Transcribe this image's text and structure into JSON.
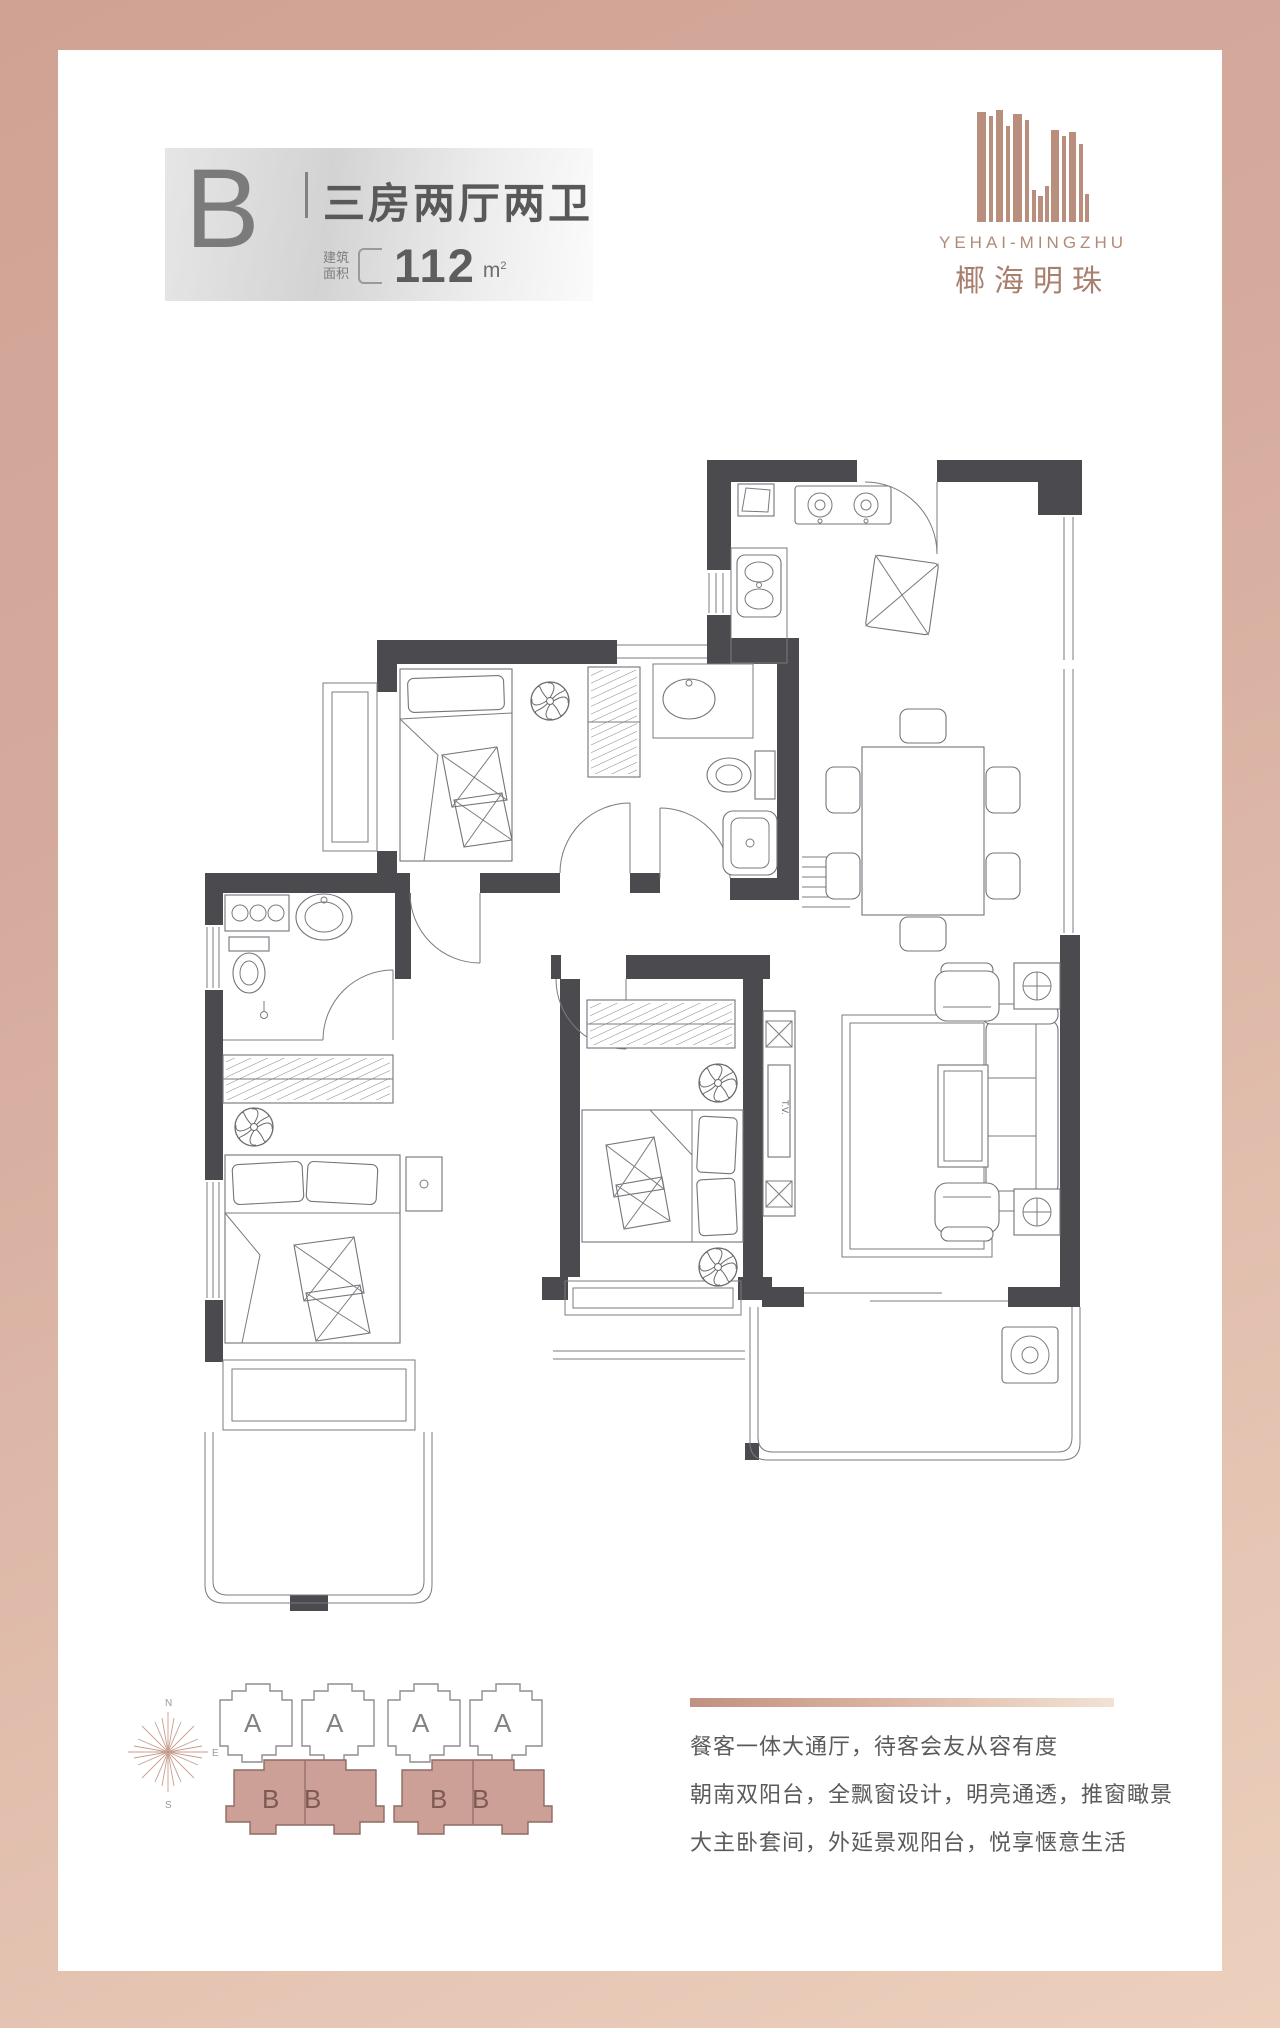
{
  "header": {
    "unit_label": "B",
    "unit_title": "三房两厅两卫",
    "area_label_line1": "建筑",
    "area_label_line2": "面积",
    "area_value": "112",
    "area_unit": "m",
    "area_sup": "2"
  },
  "logo": {
    "en": "YEHAI-MINGZHU",
    "cn": "椰海明珠"
  },
  "floorplan": {
    "tv_label": "T.V."
  },
  "keyplan": {
    "compass": {
      "n": "N",
      "e": "E",
      "s": "S",
      "w": "W"
    },
    "a_labels": [
      "A",
      "A",
      "A",
      "A"
    ],
    "b_labels": [
      "B",
      "B",
      "B",
      "B"
    ]
  },
  "description": {
    "lines": [
      "餐客一体大通厅，待客会友从容有度",
      "朝南双阳台，全飘窗设计，明亮通透，推窗瞰景",
      "大主卧套间，外延景观阳台，悦享惬意生活"
    ]
  },
  "colors": {
    "frame_rose": "#d3a99c",
    "frame_rose_light": "#ecd0bd",
    "logo_rose": "#b98e7c",
    "wall_dark": "#4b4b4f",
    "keyplan_b_fill": "#cc9f97"
  }
}
